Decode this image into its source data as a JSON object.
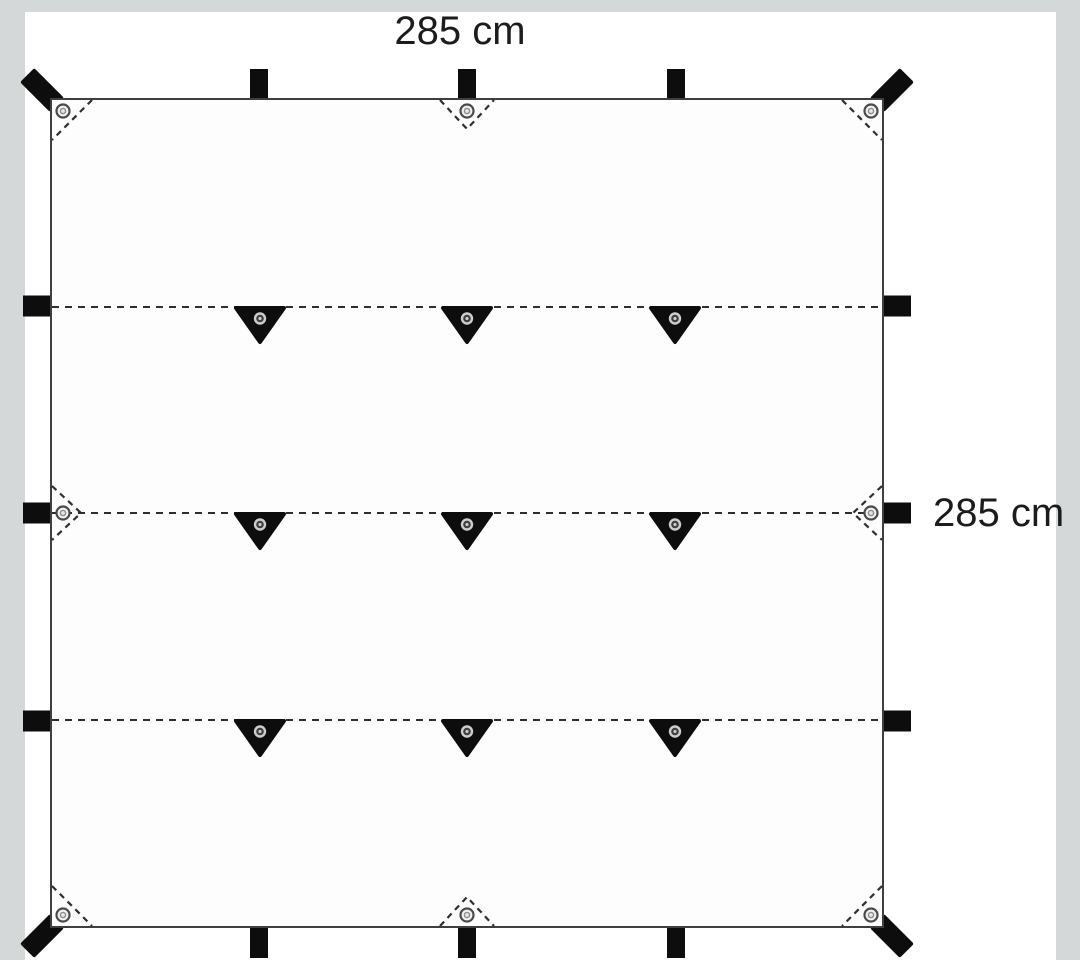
{
  "page": {
    "background_color": "#d5d8d9",
    "card_color": "#ffffff"
  },
  "diagram": {
    "top_dimension_label": "285 cm",
    "right_dimension_label": "285 cm",
    "colors": {
      "ink": "#0d0d0d",
      "outline": "#3f3f3f",
      "dash": "#2f2f2f",
      "grommet_ring": "#4a4a4a",
      "grommet_fill": "#f1f1f1"
    },
    "grid": {
      "row_fractions_pct": [
        25,
        50,
        75
      ],
      "col_fractions_pct": [
        25,
        50,
        75
      ]
    },
    "features": {
      "interior_tie_loops": 9,
      "corner_grommet_patches": 4,
      "edge_grommet_patches": 4,
      "edge_webbing_tabs": 12,
      "corner_webbing_tabs": 4
    }
  }
}
